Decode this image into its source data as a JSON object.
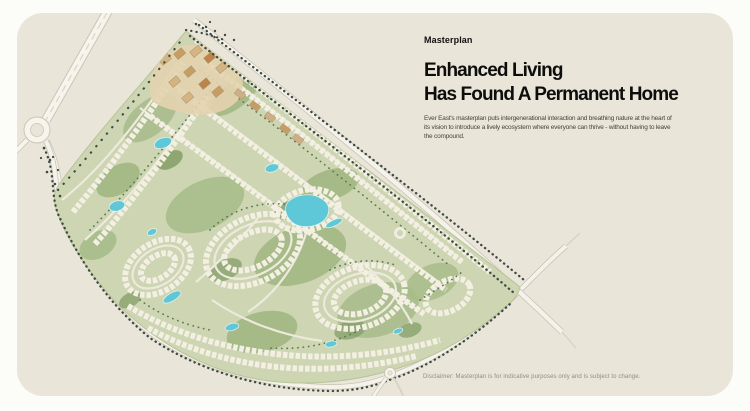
{
  "page": {
    "background_color": "#fcfcf9",
    "card_background_color": "#e9e5d9"
  },
  "masterplan_section": {
    "eyebrow": "Masterplan",
    "heading_line1": "Enhanced Living",
    "heading_line2": "Has Found A Permanent Home",
    "description": "Ever East's masterplan puts intergenerational interaction and breathing nature at the heart of its vision to introduce a lively ecosystem where everyone can thrive - without having to leave the compound.",
    "disclaimer": "Disclaimer: Masterplan is for indicative purposes only and is subject to change."
  },
  "map": {
    "kind": "masterplan-illustration",
    "features": [
      "highway-with-median",
      "left-roundabout",
      "tree-lined-boundary-avenue",
      "right-road-interchange",
      "bottom-roundabout",
      "residential-loop-clusters",
      "parks-and-greenery",
      "lagoons-and-ponds",
      "tan-village-centre"
    ],
    "colors": {
      "greenery_base": "#cdd5b2",
      "greenery_dark": "#7f9a63",
      "dark_trees": "#3f4a44",
      "water": "#5fc8d8",
      "road_fill": "#f6f4ec",
      "road_casing": "#c9c5b6",
      "building_rows": "#f3f0e3",
      "village_tan": "#d3b584"
    }
  }
}
